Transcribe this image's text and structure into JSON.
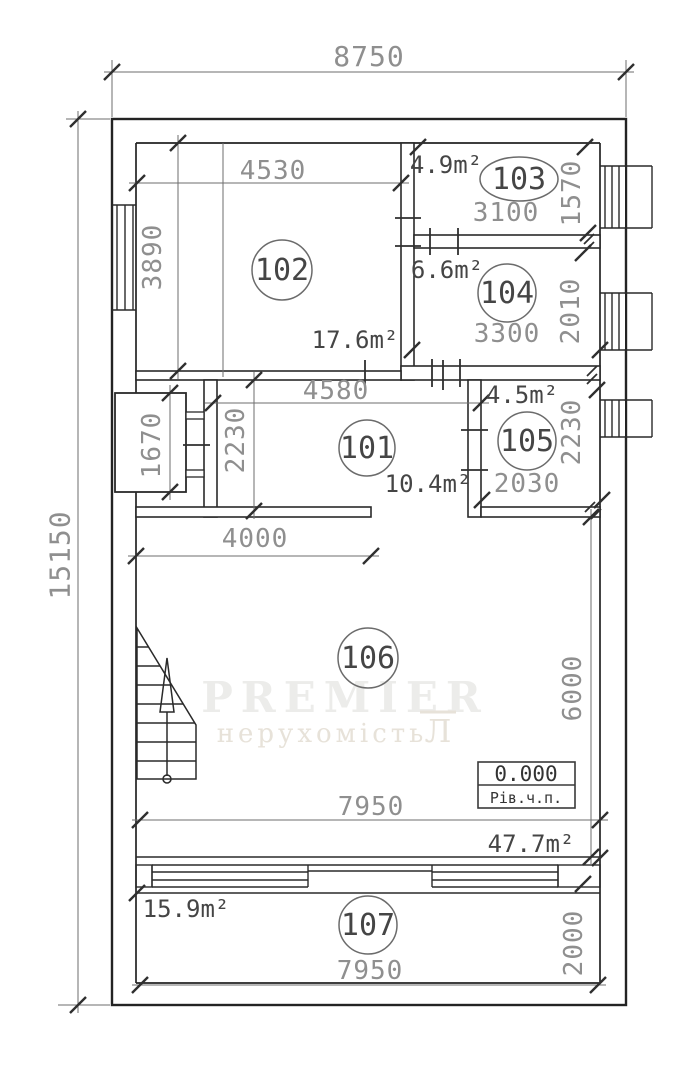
{
  "overall": {
    "width_mm": "8750",
    "height_mm": "15150"
  },
  "rooms": {
    "r101": {
      "number": "101",
      "area": "10.4m²",
      "width": "4580",
      "height": "2230"
    },
    "r102": {
      "number": "102",
      "area": "17.6m²",
      "width": "4530",
      "height": "3890"
    },
    "r103": {
      "number": "103",
      "area": "4.9m²",
      "width": "3100",
      "height": "1570"
    },
    "r104": {
      "number": "104",
      "area": "6.6m²",
      "width": "3300",
      "height": "2010"
    },
    "r105": {
      "number": "105",
      "area": "4.5m²",
      "width": "2030",
      "height": "2230"
    },
    "r106": {
      "number": "106",
      "area": "47.7m²",
      "width": "7950",
      "height": "6000",
      "opening_width": "4000"
    },
    "r107": {
      "number": "107",
      "area": "15.9m²",
      "width": "7950",
      "height": "2000"
    }
  },
  "niche": {
    "height": "1670"
  },
  "level_mark": {
    "value": "0.000",
    "label": "Рів.ч.п."
  },
  "watermark": {
    "brand": "PREMIER",
    "subtitle": "нерухомість",
    "mark": "Л"
  }
}
